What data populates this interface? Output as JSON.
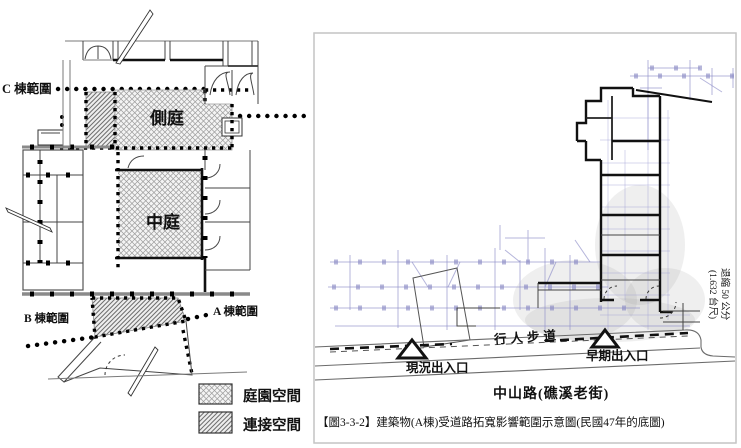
{
  "left_plan": {
    "labels": {
      "c_zone": "C 棟範圍",
      "b_zone": "B 棟範圍",
      "a_zone": "A 棟範圍",
      "side_court": "側庭",
      "central_court": "中庭"
    },
    "legend": [
      {
        "pattern": "garden-crosshatch",
        "label": "庭園空間"
      },
      {
        "pattern": "link-diagonal-hatch",
        "label": "連接空間"
      }
    ]
  },
  "right_plan": {
    "labels": {
      "current_entrance": "現況出入口",
      "early_entrance": "早期出入口",
      "pedestrian_path": "行人步道",
      "setback_line1": "退縮 50 公分",
      "setback_line2": "(1.632 台尺)",
      "road_name": "中山路(礁溪老街)"
    },
    "caption": "【圖3-3-2】建築物(A棟)受道路拓寬影響範圍示意圖(民國47年的底圖)"
  },
  "colors": {
    "ink": "#111111",
    "blueprint_underlay": "#8d8dc8",
    "frame_border": "#c4c4c4",
    "hatch_gray": "#8f8f8f"
  }
}
